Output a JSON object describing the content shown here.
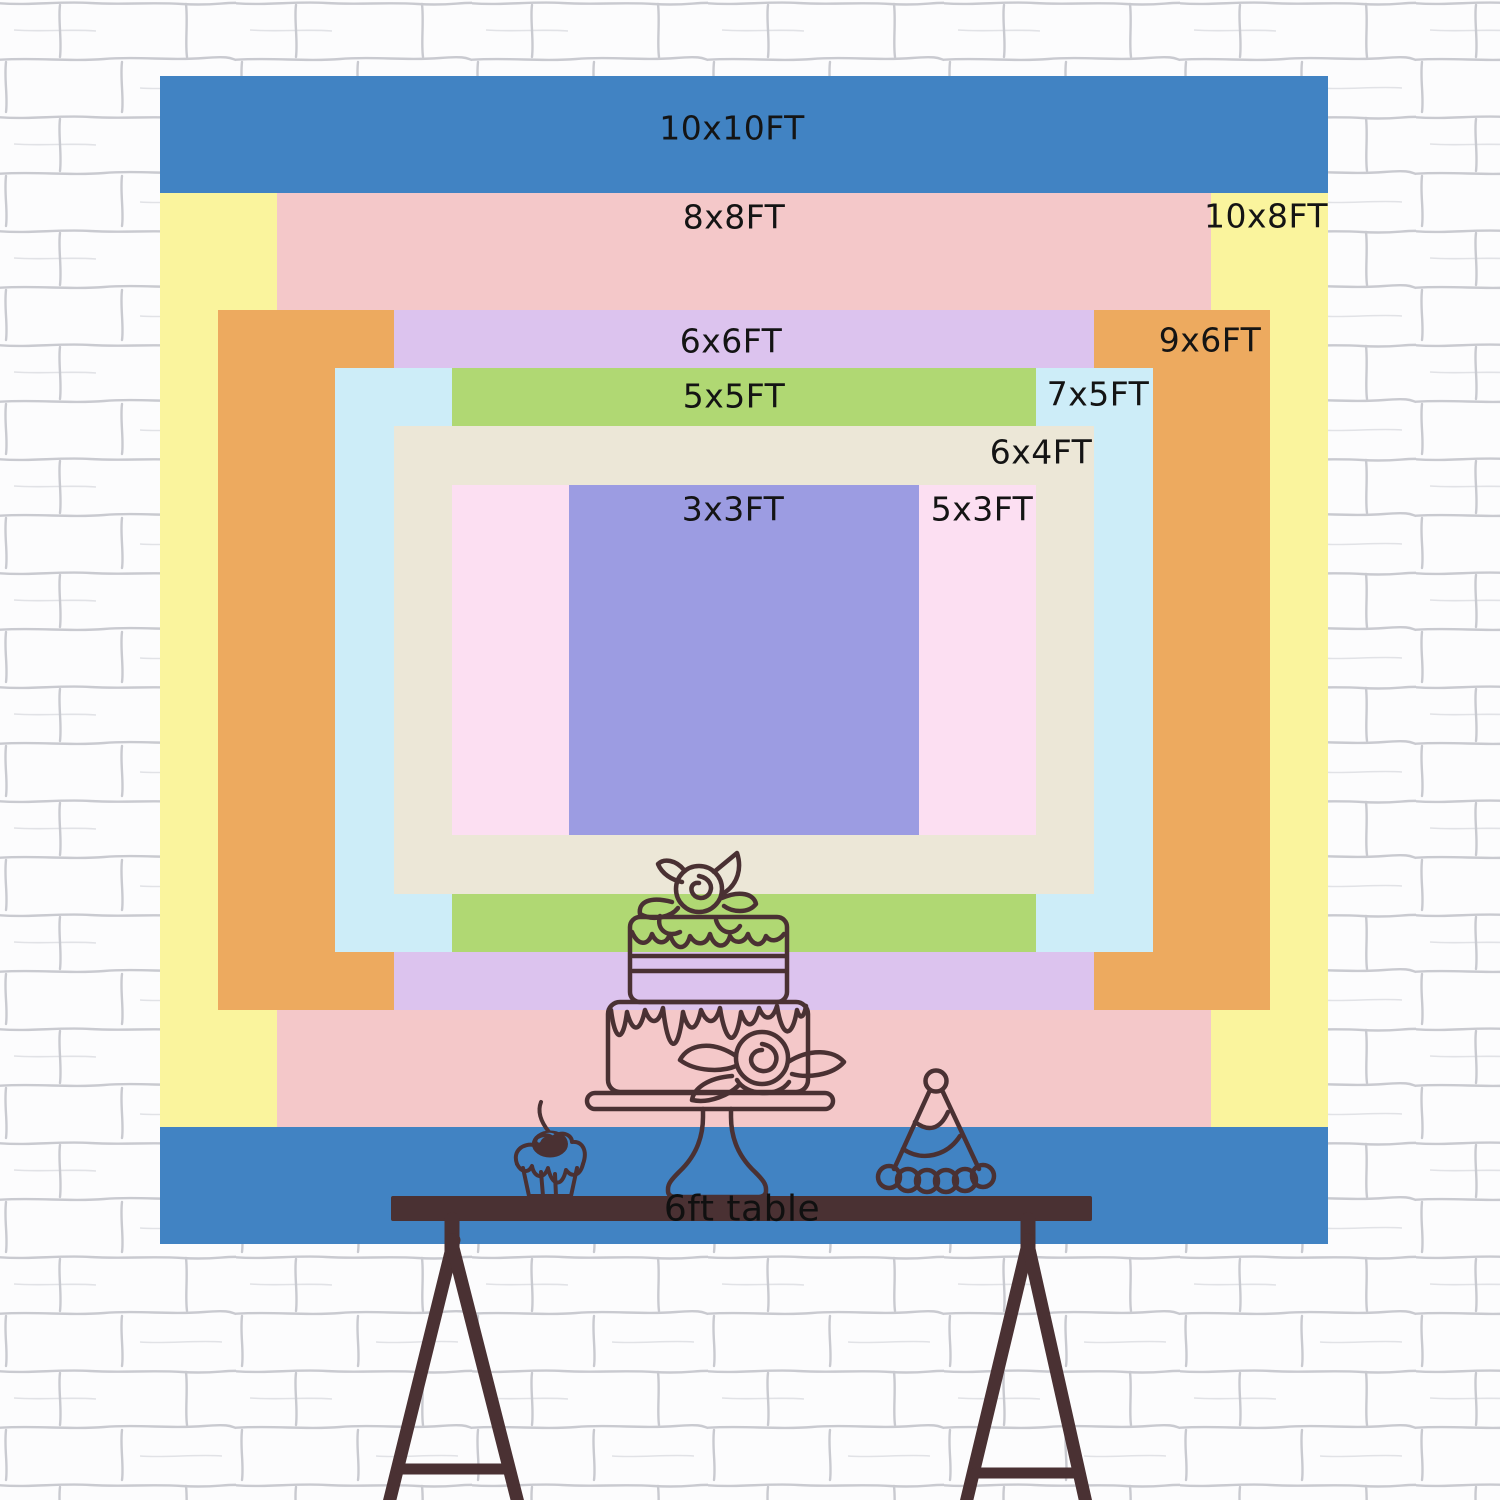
{
  "backdrop_chart": {
    "sizes": [
      {
        "id": "10x10",
        "label": "10x10FT",
        "width_ft": 10,
        "height_ft": 10,
        "color": "#4183c3"
      },
      {
        "id": "10x8",
        "label": "10x8FT",
        "width_ft": 10,
        "height_ft": 8,
        "color": "#faf49d"
      },
      {
        "id": "8x8",
        "label": "8x8FT",
        "width_ft": 8,
        "height_ft": 8,
        "color": "#f4c8c9"
      },
      {
        "id": "9x6",
        "label": "9x6FT",
        "width_ft": 9,
        "height_ft": 6,
        "color": "#edaa5f"
      },
      {
        "id": "6x6",
        "label": "6x6FT",
        "width_ft": 6,
        "height_ft": 6,
        "color": "#dcc3ee"
      },
      {
        "id": "7x5",
        "label": "7x5FT",
        "width_ft": 7,
        "height_ft": 5,
        "color": "#cdedf8"
      },
      {
        "id": "5x5",
        "label": "5x5FT",
        "width_ft": 5,
        "height_ft": 5,
        "color": "#b0d873"
      },
      {
        "id": "6x4",
        "label": "6x4FT",
        "width_ft": 6,
        "height_ft": 4,
        "color": "#ece7d7"
      },
      {
        "id": "5x3",
        "label": "5x3FT",
        "width_ft": 5,
        "height_ft": 3,
        "color": "#fcdff2"
      },
      {
        "id": "3x3",
        "label": "3x3FT",
        "width_ft": 3,
        "height_ft": 3,
        "color": "#9c9ce2"
      }
    ],
    "label_color": "#141414"
  },
  "table": {
    "label": "6ft table",
    "wood_color": "#4a3133"
  },
  "scene": {
    "wall_color": "#fcfcfd",
    "mortar_color": "#9fa0ab",
    "sketch_color": "#4a3133"
  }
}
